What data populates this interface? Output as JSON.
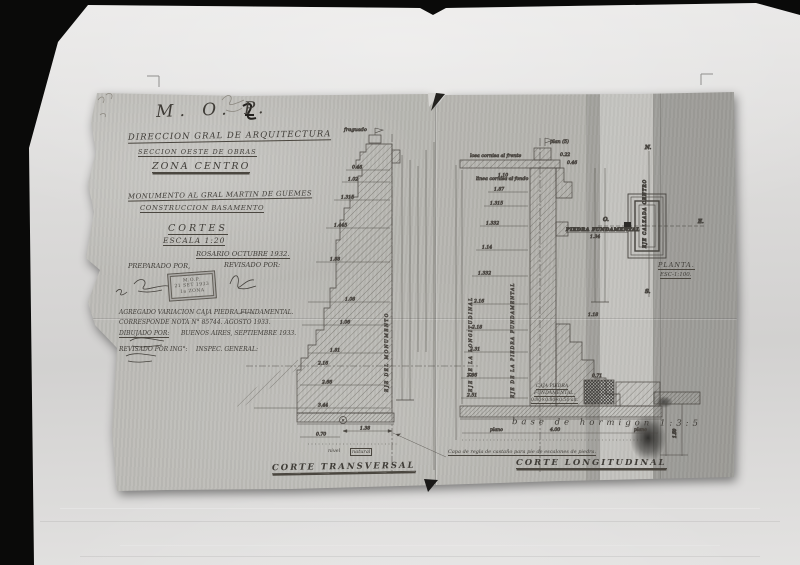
{
  "title_block": {
    "agency": "M. O. P.",
    "line1": "DIRECCION GRAL DE ARQUITECTURA",
    "line2": "SECCION OESTE DE OBRAS",
    "line3": "ZONA CENTRO",
    "line4": "MONUMENTO AL GRAL MARTIN DE GUEMES",
    "line5": "CONSTRUCCION BASAMENTO",
    "line6": "CORTES",
    "line7": "ESCALA 1:20",
    "line8": "ROSARIO OCTUBRE 1932.",
    "prepared_label": "PREPARADO POR,",
    "revised_label": "REVISADO POR:",
    "stamp": {
      "line1": "M.O.P.",
      "line2": "21 SET 1933",
      "line3": "1a ZONA"
    },
    "note1": "AGREGADO VARIACION CAJA PIEDRA FUNDAMENTAL.",
    "note2": "CORRESPONDE NOTA N° 85744. AGOSTO 1933.",
    "drawn_label": "DIBUJADO POR:",
    "city_date": "BUENOS AIRES, SEPTIEMBRE 1933.",
    "revised2_label": "REVISADO POR ING°:",
    "inspector_label": "INSPEC. GENERAL:"
  },
  "sections": {
    "transversal": {
      "caption": "CORTE TRANSVERSAL",
      "axis_label": "EJE DEL MONUMENTO",
      "top_note": "fraguado",
      "ground_note_a": "nivel",
      "ground_note_b": "natural",
      "dims": [
        "0.46",
        "1.02",
        "1.315",
        "1.445",
        "1.88",
        "1.08",
        "1.06",
        "1.81",
        "2.16",
        "2.66",
        "3.44",
        "1.38",
        "0.70"
      ]
    },
    "longitudinal": {
      "caption": "CORTE LONGITUDINAL",
      "axis_label": "EJE DE LA LONGITUDINAL",
      "axis_label2": "EJE DE LA PIEDRA FUNDAMENTAL",
      "top_note": "plan (5)",
      "cornice_note": "losa cornisa al frente",
      "cornice_note2": "linea cornisa al fondo",
      "box_label1": "CAJA PIEDRA",
      "box_label2": "FUNDAMENTAL.",
      "box_label3": "0.80×0.80×0.50 alt.",
      "box_top_dim": "0.71",
      "concrete_note": "base de hormigon 1:3:5",
      "row_word_left": "plano",
      "row_word_right": "plano",
      "footing_row_dim": "4.00",
      "step_note": "Capa de regla de castaño para pie de escalones de piedra.",
      "dims": [
        "1.10",
        "1.87",
        "1.315",
        "1.332",
        "1.14",
        "1.332",
        "2.16",
        "2.18",
        "2.31",
        "2.86",
        "2.51"
      ],
      "side_dims": [
        "0.22",
        "0.46",
        "1.34",
        "1.18"
      ],
      "detail_dim": "1.50"
    }
  },
  "planta": {
    "caption": "PLANTA.",
    "scale": "ESC-1:100.",
    "north": "N.",
    "south": "S.",
    "east": "E.",
    "west": "O.",
    "axis_label": "EJE CALZADA CENTRO",
    "marker_label": "PIEDRA FUNDAMENTAL"
  }
}
